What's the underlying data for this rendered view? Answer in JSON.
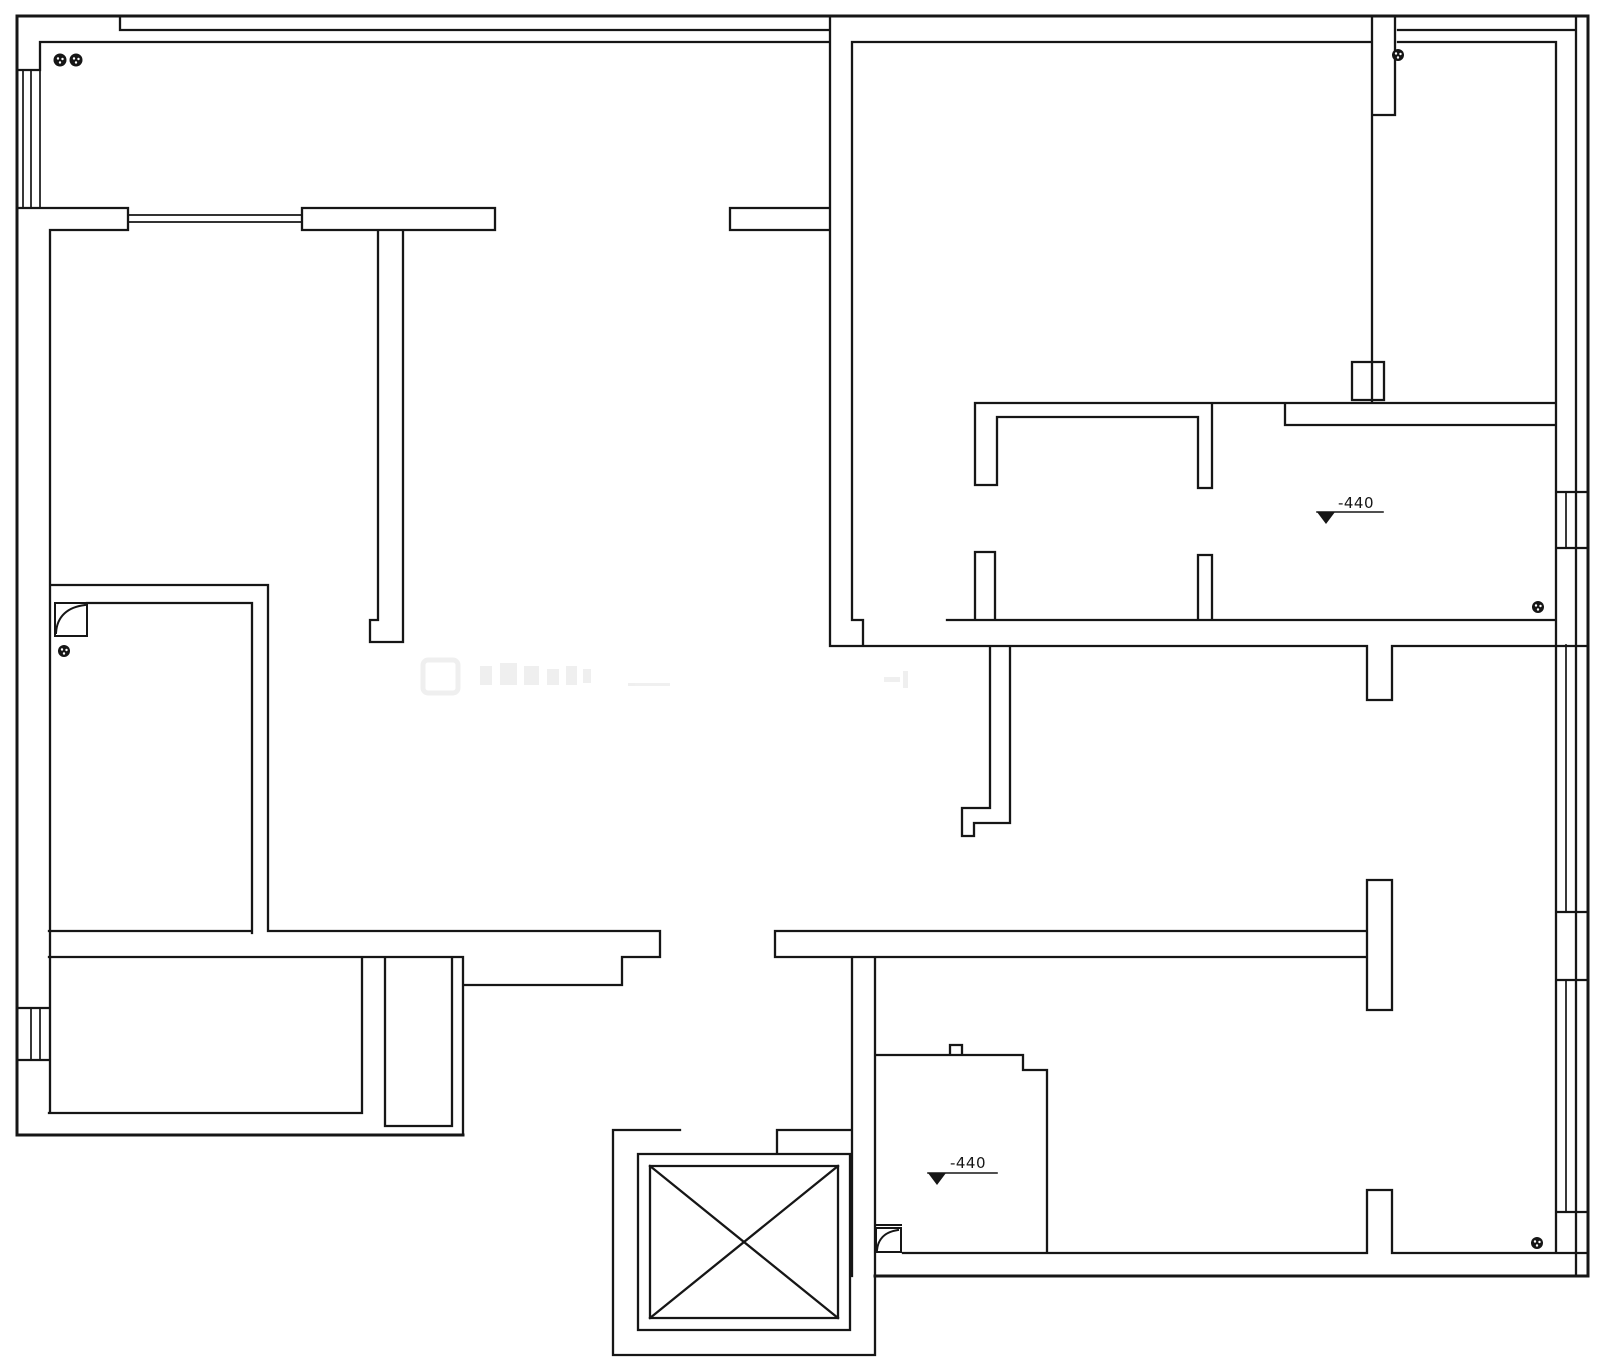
{
  "page": {
    "background": "#ffffff"
  },
  "drawing": {
    "type": "floor-plan",
    "line_color": "#161616",
    "watermark_color": "#000000",
    "annotations": {
      "upper_level_marker": {
        "label": "-440"
      },
      "lower_level_marker": {
        "label": "-440"
      }
    },
    "symbols": {
      "elevator_shaft": "crossed-box",
      "junction_dot_count": 6,
      "door_leaf_count": 2,
      "window_symbol_count": 6
    }
  }
}
